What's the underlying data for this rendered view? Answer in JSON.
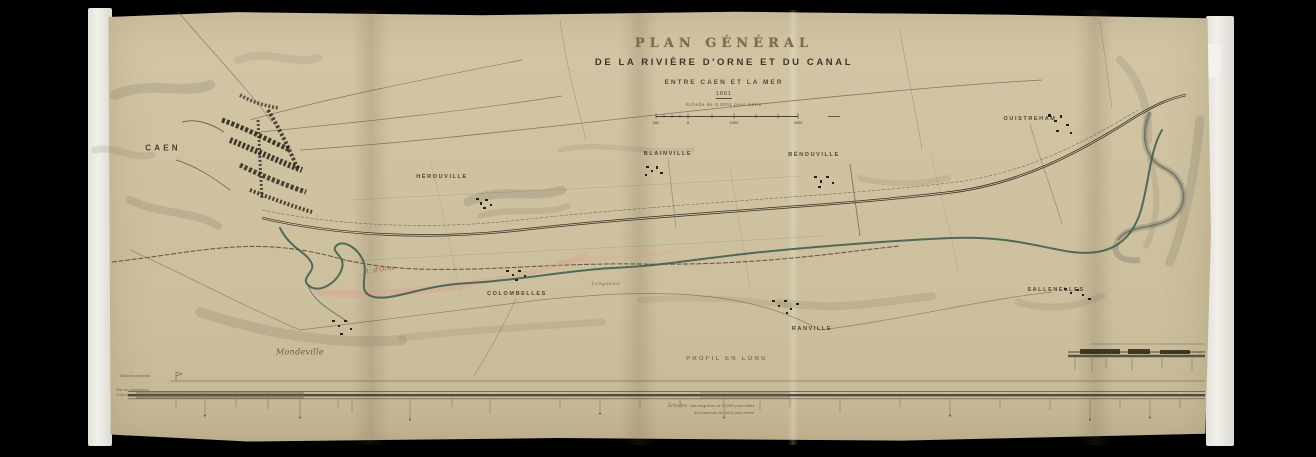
{
  "map": {
    "title": "PLAN GÉNÉRAL",
    "subtitle": "DE LA RIVIÈRE D'ORNE ET DU CANAL",
    "between": "ENTRE CAEN ET LA MER",
    "date": "1861",
    "scale_label": "Échelle de 0,0001 pour mètre",
    "scale_ticks": [
      "500",
      "0",
      "1000",
      "2000"
    ]
  },
  "places": [
    {
      "name": "CAEN"
    },
    {
      "name": "HÉROUVILLE"
    },
    {
      "name": "BLAINVILLE"
    },
    {
      "name": "BÉNOUVILLE"
    },
    {
      "name": "OUISTREHAM"
    },
    {
      "name": "COLOMBELLES"
    },
    {
      "name": "RANVILLE"
    },
    {
      "name": "SALLENELLES"
    },
    {
      "name": "Mondeville"
    }
  ],
  "labels": {
    "river": "R. d'Orne",
    "hamlet": "Longueval"
  },
  "profile": {
    "title": "PROFIL EN LONG",
    "scales_heading": "Échelles",
    "scale_lines": [
      "des longueurs de 0,0002 pour mètre",
      "des hauteurs de 0,002 pour mètre"
    ],
    "row_labels": [
      "Distances partielles",
      "Plan de comparaison",
      "Cotes du terrain"
    ]
  },
  "colors": {
    "background": "#000000",
    "mat_white": "#edebe5",
    "paper": "#cfc3a2",
    "ink": "#3a3226",
    "river_green": "#41604f",
    "flood_pink": "#dd9a90",
    "label_red": "#a8473a"
  }
}
